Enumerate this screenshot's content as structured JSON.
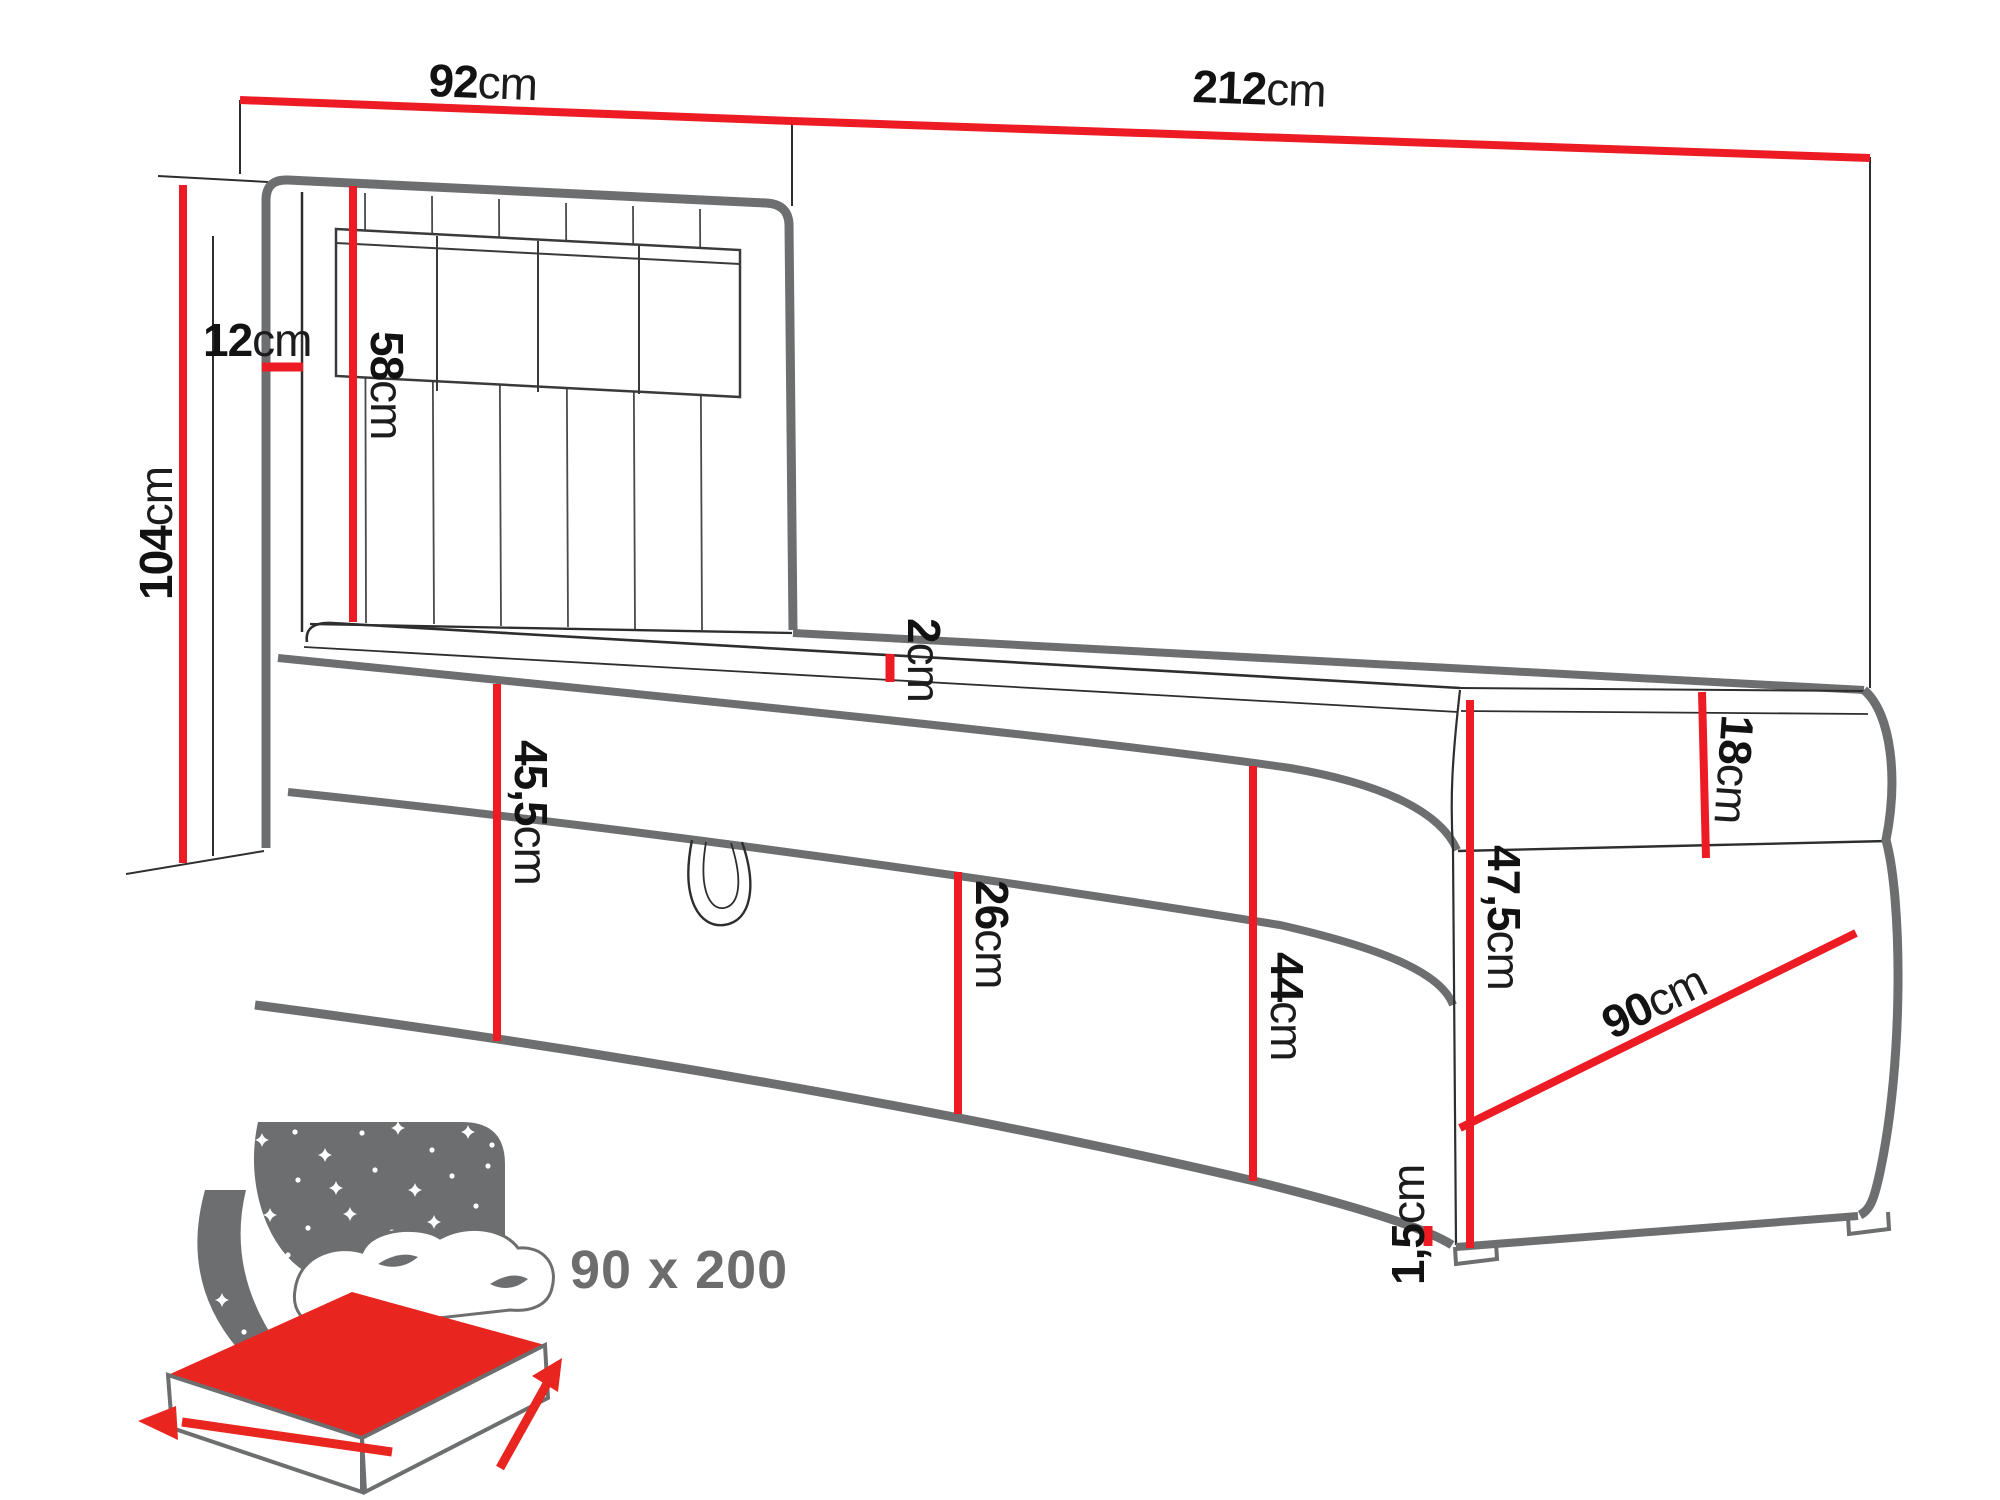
{
  "diagram": {
    "title": "boxspring-bed-dimension-diagram",
    "accent_color": "#ed1c24",
    "outline_color": "#6d6e70",
    "dimensions": {
      "headboard_width": {
        "num": "92",
        "unit": "cm"
      },
      "total_length": {
        "num": "212",
        "unit": "cm"
      },
      "total_height": {
        "num": "104",
        "unit": "cm"
      },
      "headboard_depth": {
        "num": "12",
        "unit": "cm"
      },
      "headboard_above_mattress": {
        "num": "58",
        "unit": "cm"
      },
      "topper_thickness": {
        "num": "2",
        "unit": "cm"
      },
      "base_height_head": {
        "num": "45,5",
        "unit": "cm"
      },
      "storage_flap_height": {
        "num": "26",
        "unit": "cm"
      },
      "base_height_foot": {
        "num": "44",
        "unit": "cm"
      },
      "foot_corner_height": {
        "num": "47,5",
        "unit": "cm"
      },
      "mattress_thickness": {
        "num": "18",
        "unit": "cm"
      },
      "bed_width_foot": {
        "num": "90",
        "unit": "cm"
      },
      "leg_height": {
        "num": "1,5",
        "unit": "cm"
      }
    },
    "badge": {
      "size_label": "90 x 200"
    }
  }
}
